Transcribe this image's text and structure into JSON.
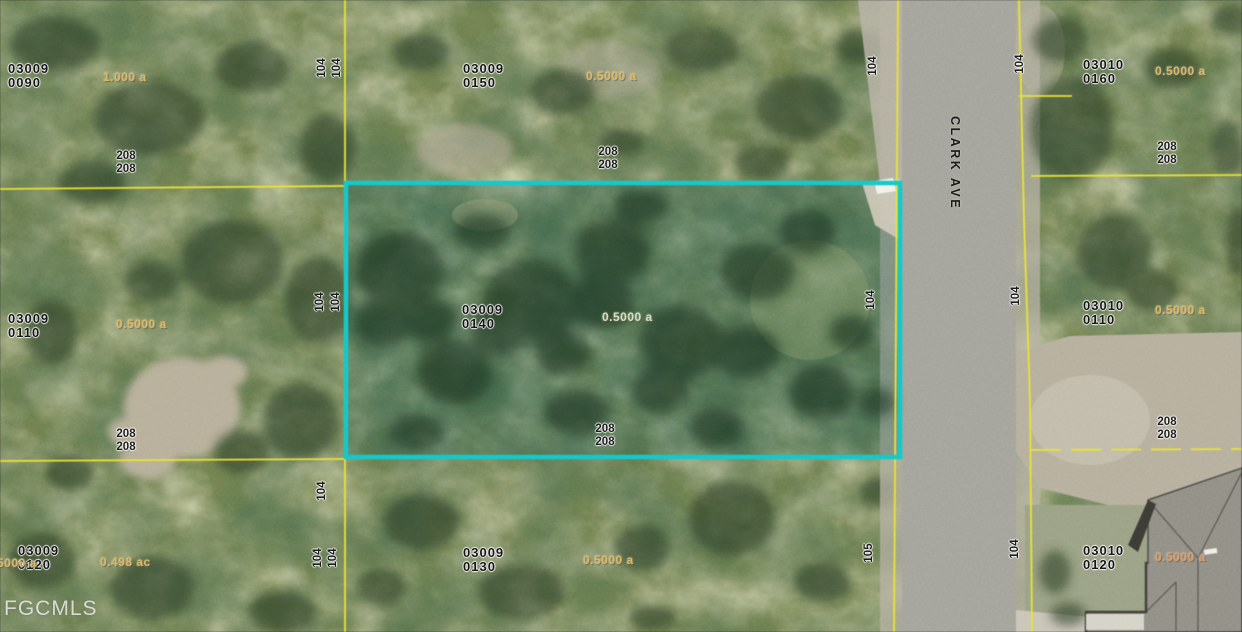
{
  "map": {
    "street_label": "CLARK AVE",
    "watermark": "FGCMLS",
    "colors": {
      "subject_highlight": "#14c9cb",
      "parcel_lines": "#e8e333"
    },
    "dims": {
      "width": "104",
      "width_alt": "105",
      "depth": "208"
    },
    "parcels": [
      {
        "key": "top-left",
        "id_line1": "03009",
        "id_line2": "0090",
        "acreage": "1.000 a"
      },
      {
        "key": "top-middle",
        "id_line1": "03009",
        "id_line2": "0150",
        "acreage": "0.5000 a"
      },
      {
        "key": "top-right",
        "id_line1": "03010",
        "id_line2": "0160",
        "acreage": "0.5000 a"
      },
      {
        "key": "mid-left",
        "id_line1": "03009",
        "id_line2": "0110",
        "acreage": "0.5000 a"
      },
      {
        "key": "subject",
        "id_line1": "03009",
        "id_line2": "0140",
        "acreage": "0.5000 a",
        "highlighted": true
      },
      {
        "key": "mid-right",
        "id_line1": "03010",
        "id_line2": "0110",
        "acreage": "0.5000 a"
      },
      {
        "key": "bottom-left",
        "id_line1": "03009",
        "id_line2": "0120",
        "acreage": "0.498 ac"
      },
      {
        "key": "bottom-middle",
        "id_line1": "03009",
        "id_line2": "0130",
        "acreage": "0.5000 a"
      },
      {
        "key": "bottom-right",
        "id_line1": "03010",
        "id_line2": "0120",
        "acreage": "0.5000 a"
      }
    ],
    "edge_partial_acreage": "0.5000 a"
  }
}
